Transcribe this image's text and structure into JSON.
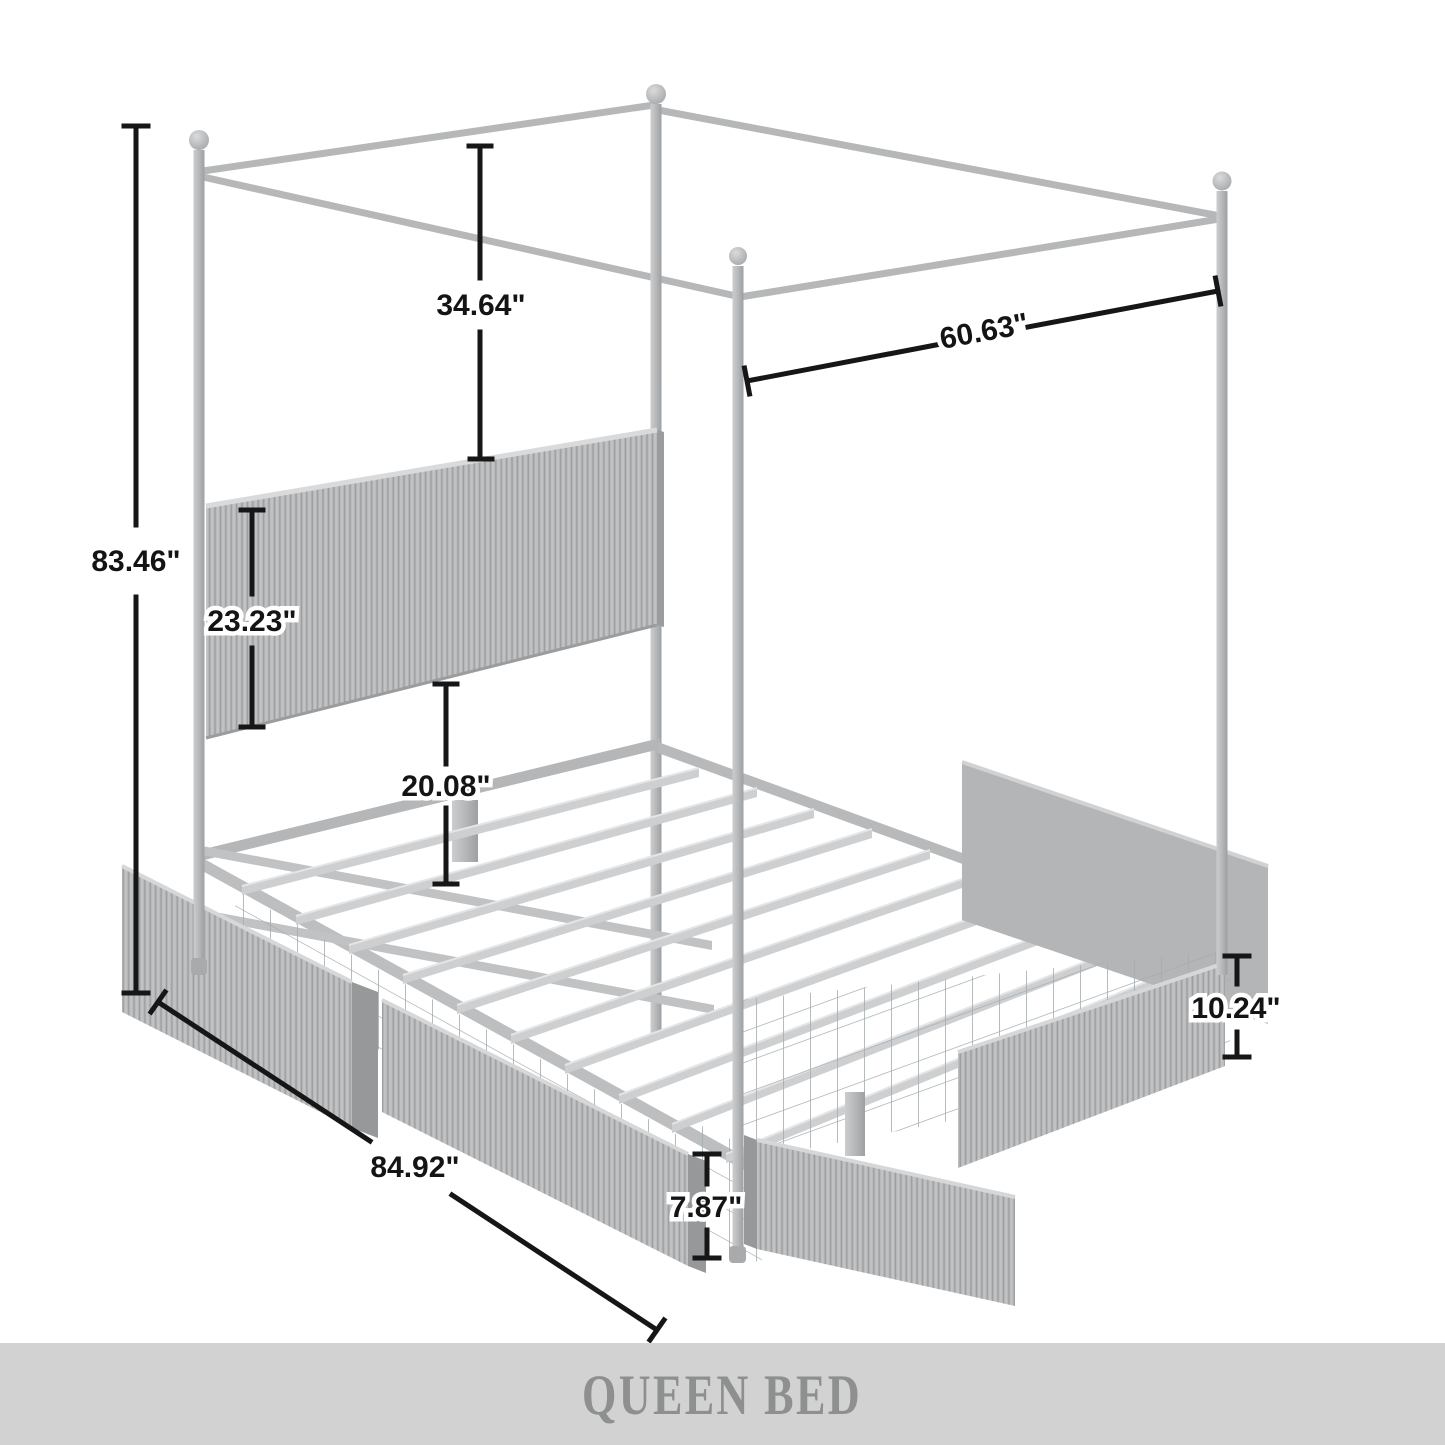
{
  "banner": {
    "title": "QUEEN BED",
    "background": "#d2d2d2",
    "text_color": "#8e9090"
  },
  "dimensions": {
    "overall_height": "83.46\"",
    "canopy_to_headboard": "34.64\"",
    "canopy_width": "60.63\"",
    "headboard_height": "23.23\"",
    "platform_height": "20.08\"",
    "overall_length": "84.92\"",
    "under_bed_clearance": "7.87\"",
    "drawer_height": "10.24\""
  },
  "colors": {
    "background": "#ffffff",
    "frame_gray": "#b5b7b9",
    "flute_light": "#b9bbbd",
    "flute_dark": "#a0a2a4",
    "dimension_line": "#161616",
    "banner_background": "#d2d2d2",
    "banner_text": "#8e9090"
  }
}
